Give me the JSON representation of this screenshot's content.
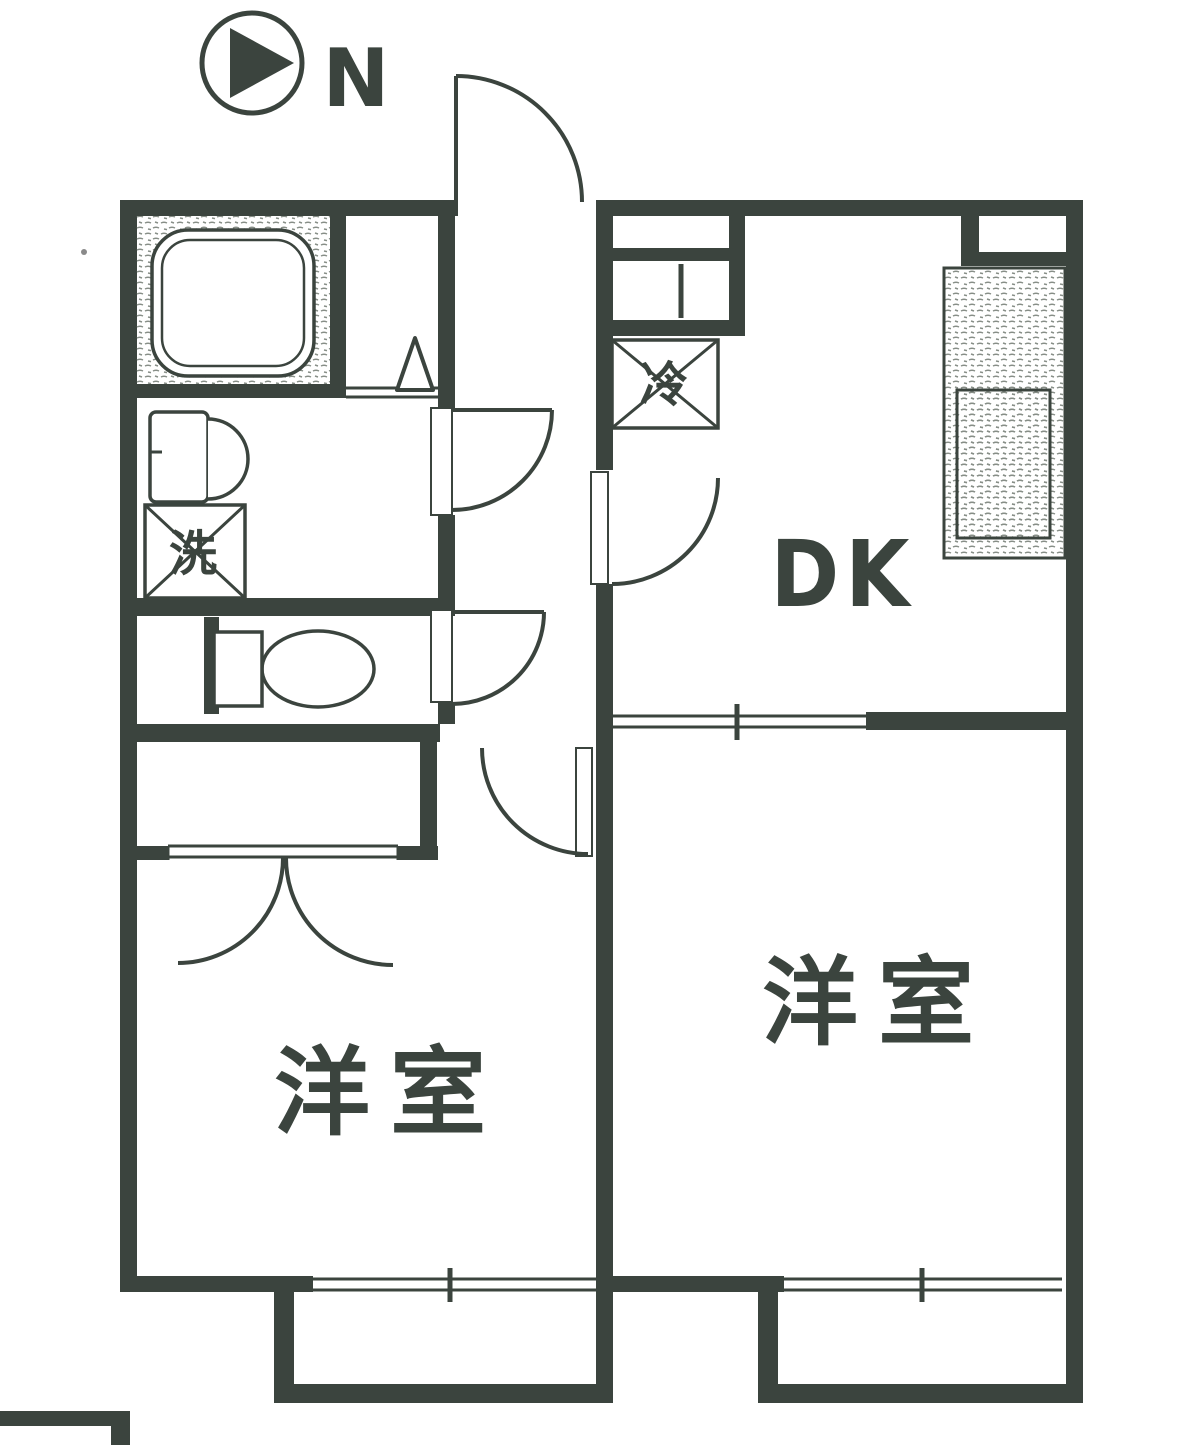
{
  "colors": {
    "ink": "#3b443e",
    "paper": "#ffffff",
    "stipple": "#878e87"
  },
  "compass": {
    "label": "N"
  },
  "labels": {
    "dining_kitchen": "DK",
    "western_room_right": "洋室",
    "western_room_left": "洋室",
    "washing_machine": "洗",
    "refrigerator": "冷"
  }
}
